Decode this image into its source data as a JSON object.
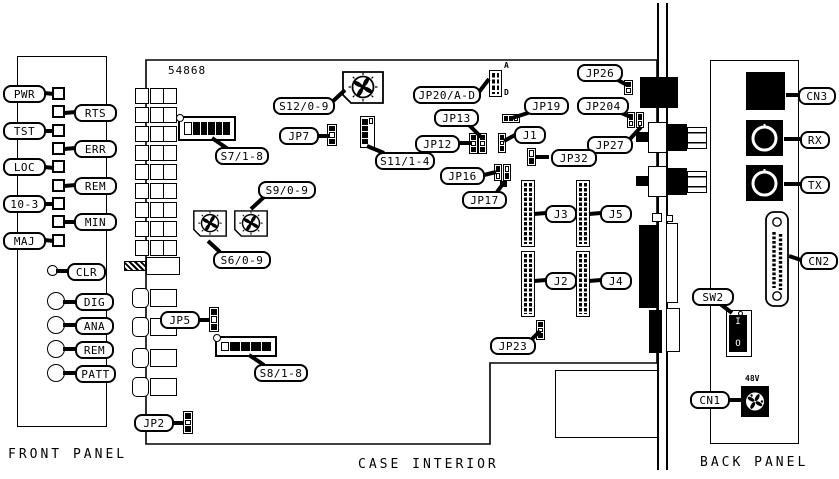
{
  "panel_titles": {
    "front": "FRONT PANEL",
    "case": "CASE INTERIOR",
    "back": "BACK PANEL"
  },
  "board_number": "54868",
  "front_panel": {
    "led_labels": [
      "PWR",
      "RTS",
      "TST",
      "ERR",
      "LOC",
      "REM",
      "10-3",
      "MIN",
      "MAJ"
    ],
    "jack_labels": [
      "CLR",
      "DIG",
      "ANA",
      "REM",
      "PATT"
    ]
  },
  "case_interior": {
    "labels": {
      "s7": "S7/1-8",
      "s12": "S12/0-9",
      "jp7": "JP7",
      "s11": "S11/1-4",
      "jp20": "JP20/A-D",
      "jp13": "JP13",
      "jp12": "JP12",
      "jp16": "JP16",
      "jp17": "JP17",
      "jp19": "JP19",
      "j1": "J1",
      "jp26": "JP26",
      "jp204": "JP204",
      "jp27": "JP27",
      "jp32": "JP32",
      "j3": "J3",
      "j5": "J5",
      "j2": "J2",
      "j4": "J4",
      "jp23": "JP23",
      "s9": "S9/0-9",
      "s6": "S6/0-9",
      "jp5": "JP5",
      "s8": "S8/1-8",
      "jp2": "JP2"
    },
    "header_marks": {
      "top": "A",
      "bottom": "D"
    }
  },
  "back_panel": {
    "labels": {
      "cn3": "CN3",
      "rx": "RX",
      "tx": "TX",
      "cn2": "CN2",
      "sw2": "SW2",
      "cn1": "CN1"
    },
    "power_switch": {
      "on": "I",
      "off": "O"
    },
    "voltage_label": "48V"
  }
}
